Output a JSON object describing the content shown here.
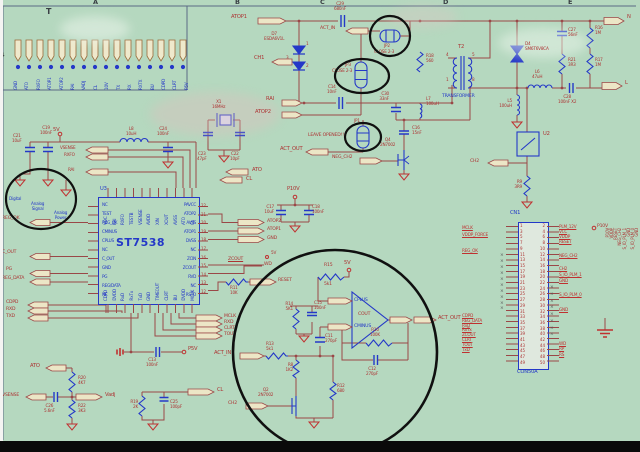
{
  "page": {
    "title": "T",
    "grid_letters": [
      "A",
      "B",
      "C",
      "D",
      "E"
    ],
    "row_marker": "4"
  },
  "header": {
    "pins": [
      "GND",
      "ATO",
      "RXFO",
      "ATOP1",
      "ATOP2",
      "RAI",
      "VADJ",
      "CL",
      "10V",
      "TX",
      "RX",
      "RXTX",
      "BU",
      "CDPD",
      "CLRT",
      "P5V"
    ]
  },
  "power": {
    "rail": "5V",
    "c21": "C21\n10uF",
    "c19": "C19\n100nF",
    "l8": "L8\n10uH",
    "c24": "C24\n100nF",
    "gnd_digital": "Digital",
    "gnd_analog_signal": "Analog\nSignal",
    "gnd_analog_power": "Analog\nPower",
    "vsense": "VSENSE",
    "rxfo": "RXFO",
    "rai": "RAI"
  },
  "osc": {
    "x1": "X1\n16MHz",
    "c23": "C23\n47pF",
    "c22": "C22\n10pF",
    "ato": "ATO",
    "cl": "CL"
  },
  "ic": {
    "ref": "U3",
    "part": "ST7538",
    "top_pins": [
      "VDC",
      "RAI",
      "RXFO",
      "TESTB",
      "VSENSE",
      "AVDD",
      "XIN",
      "XOUT",
      "AVSS",
      "ATO",
      "CL"
    ],
    "left_pins": [
      "NC",
      "TEST",
      "REG_OK",
      "CMINUS",
      "CPLUS",
      "NC",
      "C_OUT",
      "GND",
      "PG",
      "REG/DATA",
      "NC"
    ],
    "right_pins": [
      "PAVCC",
      "ATOP2",
      "AVSS",
      "ATOP1",
      "DVSS",
      "NC",
      "ZCIN",
      "ZCOUT",
      "RVD",
      "NC",
      "RSTO"
    ],
    "right_pin_numbers": [
      "22",
      "21",
      "20",
      "19",
      "18",
      "17",
      "16",
      "15",
      "14",
      "13",
      "12"
    ],
    "bottom_pins": [
      "CDPD",
      "DVDD",
      "RxD",
      "RxTx",
      "TxD",
      "GND",
      "TIMEOUT",
      "CLRT",
      "BU",
      "DVDD",
      "MCLK"
    ]
  },
  "ic_nets": {
    "atop2": "ATOP2",
    "atop1": "ATOP1",
    "gnd": "GND",
    "zcout": "ZCOUT",
    "v5": "5V",
    "wd": "WD",
    "reset": "RESET",
    "r11": "R11\n10K"
  },
  "p10v": {
    "net": "P10V",
    "c17": "C17\n10uF",
    "c18": "C18\n100nF"
  },
  "left_nets": {
    "reg_ok": "REG_OK",
    "c_out": "C_OUT",
    "pg": "PG",
    "reg_data": "REG_DATA",
    "cdpd": "CDPD",
    "rxd": "RXD",
    "txd": "TXD"
  },
  "serial": {
    "mclk": "MCLK",
    "rxd": "RXD",
    "clrt": "CLRT",
    "tout": "TOUT",
    "p5v": "P5V",
    "c13": "C13\n100nF"
  },
  "adj": {
    "ato": "ATO",
    "r20": "R20\n4K7",
    "vsense": "VSENSE",
    "c26": "C26\n5.6nF",
    "r22": "R22\n3K3",
    "vadj": "Vadj",
    "r19": "R19\n2K",
    "c25": "C25\n100pF",
    "cl": "CL"
  },
  "driver": {
    "atop1": "ATOP1",
    "act_in": "ACT_IN",
    "c29": "C29\n680nF",
    "d7": "D7\nESDA6V1L",
    "d7_p1": "1",
    "d7_p2": "2",
    "d7_p3": "3",
    "ch1": "CH1",
    "rai": "RAI",
    "atop2": "ATOP2",
    "c14": "C14\n10nF",
    "jp2": "JP2",
    "jp2_note": "CLOSE 2-3",
    "jp3": "JP3",
    "jp3_note": "CLOSE 2-3",
    "c30": "C30\n33nF",
    "r18": "R18\n560",
    "l7": "L7\n100uH",
    "jp1": "JP1",
    "jp1_note": "LEAVE OPENED!!",
    "act_out": "ACT_OUT",
    "neg_ch2": "NEG_CH2",
    "q4": "Q4\n2N7002",
    "c16": "C16\n15nF"
  },
  "coupling": {
    "t2": "T2",
    "transformer": "TRANSFORMER",
    "p4": "4",
    "p5": "5",
    "p1": "1",
    "p8": "8",
    "d4": "D4\nSM6T6V8CA",
    "l5": "L5\n100uH",
    "l6": "L6\n47uH",
    "c27": "C27\n56nF",
    "r21": "R21\n3R3",
    "r16": "R16\n1M",
    "r17": "R17\n1M",
    "c28": "C28\n100nF X2",
    "line_top": "N",
    "line_bottom": "L",
    "u2": "U2",
    "r9": "R9\n3R9",
    "ch2": "CH2"
  },
  "filter": {
    "r15": "R15",
    "r15_val": "5k1",
    "v5": "5V",
    "cplus": "CPLUS",
    "cminus": "CMINUS",
    "cout": "COUT",
    "act_out": "ACT_OUT",
    "r14": "R14\n5K1",
    "c15": "C15\n100nF",
    "c11": "C11\n270pF",
    "r13": "R13\n5k1",
    "act_in": "ACT_IN",
    "r8": "R8\n1K2",
    "r12": "R12\n680",
    "c12": "C12\n270pF",
    "r10": "R10\n100K",
    "q2": "Q2\n2N7002",
    "ch2": "CH2"
  },
  "cn1": {
    "ref": "CN1",
    "part": "CON50A",
    "left_numbers": [
      "1",
      "3",
      "5",
      "7",
      "9",
      "11",
      "13",
      "15",
      "17",
      "19",
      "21",
      "23",
      "25",
      "27",
      "29",
      "31",
      "33",
      "35",
      "37",
      "39",
      "41",
      "43",
      "45",
      "47",
      "49"
    ],
    "right_numbers": [
      "2",
      "4",
      "6",
      "8",
      "10",
      "12",
      "14",
      "16",
      "18",
      "20",
      "22",
      "24",
      "26",
      "28",
      "30",
      "32",
      "34",
      "36",
      "38",
      "40",
      "42",
      "44",
      "46",
      "48",
      "50"
    ],
    "left_top": [
      "MCLK",
      "VDDP_FORCE"
    ],
    "reg_ok": "REG_OK",
    "left_bottom": [
      "CDPD",
      "REG_DATA",
      "RxD",
      "RxTx",
      "ZCOUT",
      "CLRT",
      "TOUT",
      "TxD"
    ],
    "right_top": [
      "PLM_12V",
      "VCC",
      "VDDP",
      "RESET"
    ],
    "neg_ch2": "NEG_CH2",
    "ch2": "CH2",
    "io1": "S_IO_PLM_1",
    "gnd1": "GND",
    "io0": "S_IO_PLM_0",
    "gnd2": "GND",
    "right_bottom": [
      "WD",
      "RP",
      "RS"
    ],
    "p10v": "P10V",
    "nc_left": [
      "×",
      "×",
      "×",
      "×",
      "×",
      "×",
      "×",
      "×",
      "×",
      "×"
    ],
    "nc_right": [
      "×",
      "×",
      "×",
      "×",
      "×",
      "×",
      "×",
      "×"
    ],
    "vertical_labels": [
      "P10V",
      "VDDP",
      "RESET",
      "NEG_CH2",
      "S_IO_PLM_1",
      "GND",
      "S_IO_PLM_0",
      "GND"
    ]
  }
}
